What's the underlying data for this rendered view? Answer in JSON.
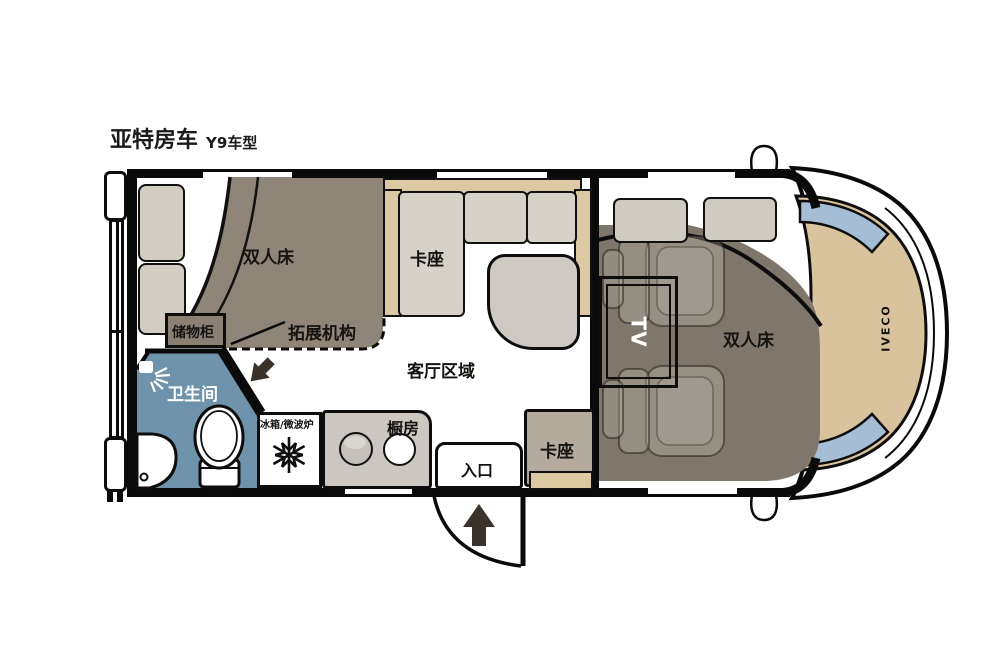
{
  "title": {
    "brand": "亚特房车",
    "model": "Y9车型"
  },
  "labels": {
    "rear_bed": "双人床",
    "storage": "储物柜",
    "expansion": "拓展机构",
    "dinette_main": "卡座",
    "living_area": "客厅区域",
    "bathroom": "卫生间",
    "fridge_microwave": "冰箱/微波炉",
    "kitchen": "橱房",
    "entrance": "入口",
    "dinette_entry": "卡座",
    "tv": "TV",
    "cab_bed": "双人床",
    "chassis_brand": "IVECO"
  },
  "icons": {
    "bathroom": "shower-head-icon",
    "fridge": "snowflake-icon",
    "entry_direction": "arrow-up-icon",
    "slide_direction": "arrow-down-left-icon"
  },
  "colors": {
    "furniture_taupe": "#8e8478",
    "cab_bed_taupe": "#7f776c",
    "cushion_light": "#d7d2c7",
    "backrest_tan": "#dcc9a3",
    "bathroom_blue": "#6f93aa",
    "hood_tan": "#d9c39d",
    "windshield_blue": "#a5bed6",
    "kitchen_gray": "#ccc7c0",
    "table_gray": "#cecac3",
    "entry_seat_gray": "#b4ab9e",
    "wall_black": "#0a0a0a",
    "arrow_dark": "#3a332b"
  }
}
